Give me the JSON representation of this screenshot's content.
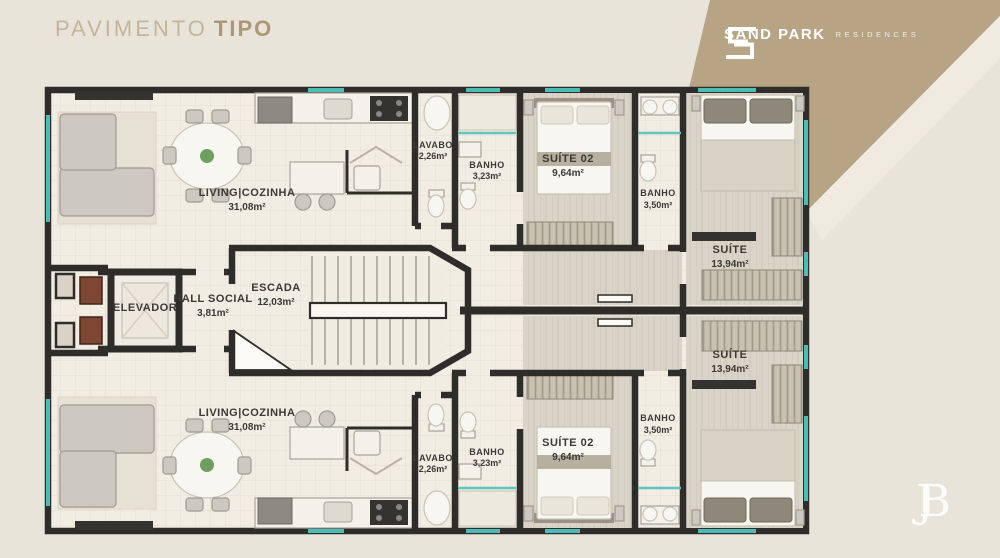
{
  "header": {
    "title_main": "PAVIMENTO",
    "title_accent": "TIPO"
  },
  "brand": {
    "name": "SAND PARK",
    "descriptor": "RESIDENCES",
    "monogram_j": "J",
    "monogram_b": "B"
  },
  "colors": {
    "background": "#e9e4da",
    "banner_tan": "#b7a485",
    "banner_light": "#f0ebe1",
    "wall": "#2f2d2a",
    "window_teal": "#49bdb6",
    "title_text": "#ab9878",
    "floor_tile": "#f1ede3",
    "floor_plank": "#dad4c8"
  },
  "plan": {
    "rooms": {
      "living_top": {
        "name": "LIVING|COZINHA",
        "area": "31,08m²"
      },
      "lavabo_top": {
        "name": "LAVABO",
        "area": "2,26m²"
      },
      "banho_small_top": {
        "name": "BANHO",
        "area": "3,23m²"
      },
      "suite02_top": {
        "name": "SUÍTE 02",
        "area": "9,64m²"
      },
      "banho_large_top": {
        "name": "BANHO",
        "area": "3,50m²"
      },
      "suite_top": {
        "name": "SUÍTE",
        "area": "13,94m²"
      },
      "elevador": {
        "name": "ELEVADOR"
      },
      "hall_social": {
        "name": "HALL SOCIAL",
        "area": "3,81m²"
      },
      "escada": {
        "name": "ESCADA",
        "area": "12,03m²"
      },
      "living_bottom": {
        "name": "LIVING|COZINHA",
        "area": "31,08m²"
      },
      "lavabo_bottom": {
        "name": "LAVABO",
        "area": "2,26m²"
      },
      "banho_small_bottom": {
        "name": "BANHO",
        "area": "3,23m²"
      },
      "suite02_bottom": {
        "name": "SUÍTE 02",
        "area": "9,64m²"
      },
      "banho_large_bottom": {
        "name": "BANHO",
        "area": "3,50m²"
      },
      "suite_bottom": {
        "name": "SUÍTE",
        "area": "13,94m²"
      }
    }
  }
}
